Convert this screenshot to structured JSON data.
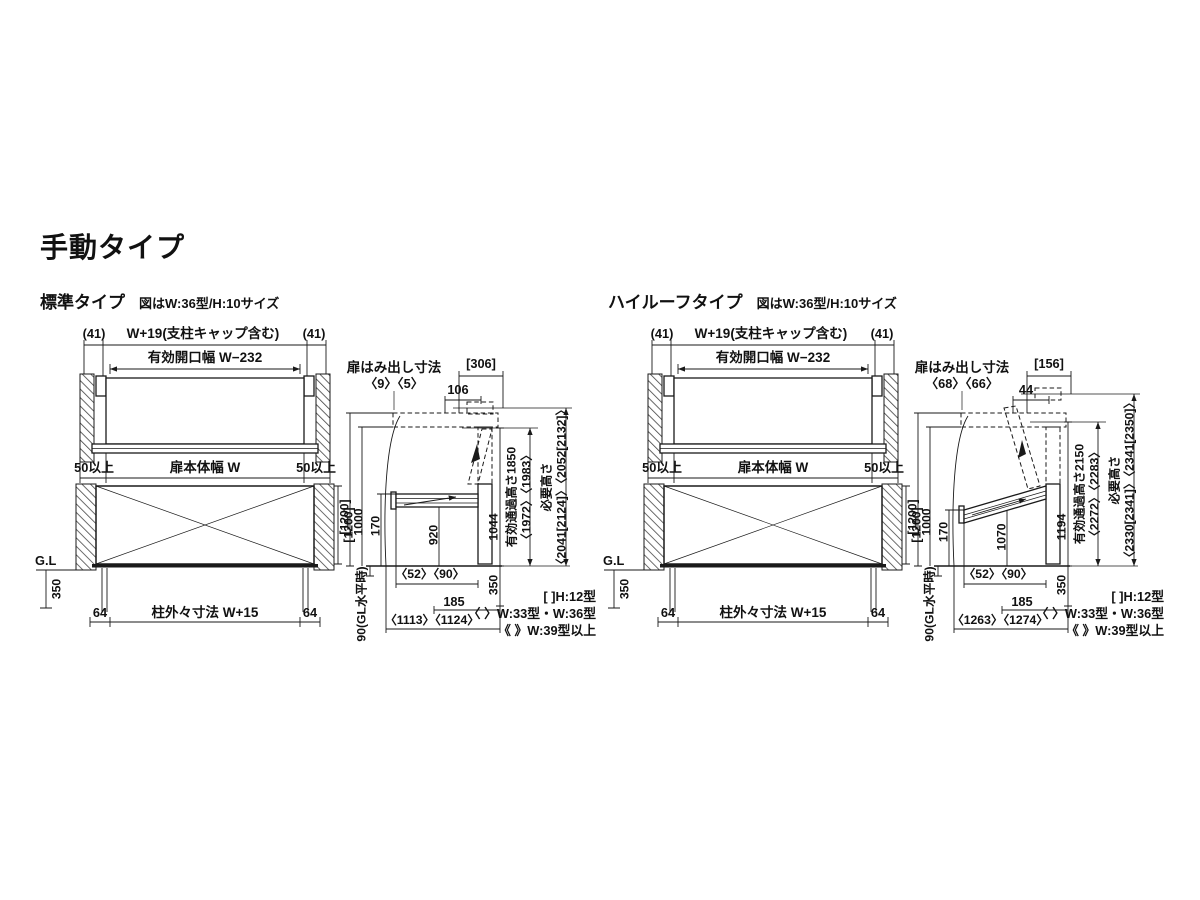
{
  "page": {
    "title": "手動タイプ"
  },
  "legend": {
    "line1": "[ ]H:12型",
    "line2": "〈 〉W:33型・W:36型",
    "line3": "《 》W:39型以上"
  },
  "diagrams": [
    {
      "heading": "標準タイプ",
      "size_note": "図はW:36型/H:10サイズ",
      "plan": {
        "cap_left": "(41)",
        "total_width": "W+19(支柱キャップ含む)",
        "cap_right": "(41)",
        "opening_width": "有効開口幅 W−232",
        "margin_left": "50以上",
        "door_width": "扉本体幅 W",
        "margin_right": "50以上"
      },
      "front": {
        "gl": "G.L",
        "depth350": "350",
        "height1200": "[1200]",
        "post_left": "64",
        "outer_width": "柱外々寸法 W+15",
        "post_right": "64"
      },
      "side": {
        "protrusion_label": "扉はみ出し寸法",
        "protrusion_values": "〈9〉〈5〉",
        "top_width": "[306]",
        "top_offset": "106",
        "h_lift": "[1200]",
        "h_1000": "1000",
        "h_170": "170",
        "h_under_door": "920",
        "h_front": "1044",
        "d_350": "350",
        "gl_offset": "90(GL水平時)",
        "passage_label": "有効通過高さ1850",
        "passage_values": "〈1972〉〈1983〉",
        "required_label": "必要高さ",
        "required_values": "〈2041[2124]〉〈2052[2132]〉",
        "w_52_90": "〈52〉〈90〉",
        "w_185": "185",
        "w_total": "〈1113〉〈1124〉"
      }
    },
    {
      "heading": "ハイルーフタイプ",
      "size_note": "図はW:36型/H:10サイズ",
      "plan": {
        "cap_left": "(41)",
        "total_width": "W+19(支柱キャップ含む)",
        "cap_right": "(41)",
        "opening_width": "有効開口幅 W−232",
        "margin_left": "50以上",
        "door_width": "扉本体幅 W",
        "margin_right": "50以上"
      },
      "front": {
        "gl": "G.L",
        "depth350": "350",
        "height1200": "[1200]",
        "post_left": "64",
        "outer_width": "柱外々寸法 W+15",
        "post_right": "64"
      },
      "side": {
        "protrusion_label": "扉はみ出し寸法",
        "protrusion_values": "〈68〉〈66〉",
        "top_width": "[156]",
        "top_offset": "44",
        "h_lift": "[1200]",
        "h_1000": "1000",
        "h_170": "170",
        "h_under_door": "1070",
        "h_front": "1194",
        "d_350": "350",
        "gl_offset": "90(GL水平時)",
        "passage_label": "有効通過高さ2150",
        "passage_values": "〈2272〉〈2283〉",
        "required_label": "必要高さ",
        "required_values": "〈2330[2341]〉〈2341[2350]〉",
        "w_52_90": "〈52〉〈90〉",
        "w_185": "185",
        "w_total": "〈1263〉〈1274〉"
      }
    }
  ]
}
